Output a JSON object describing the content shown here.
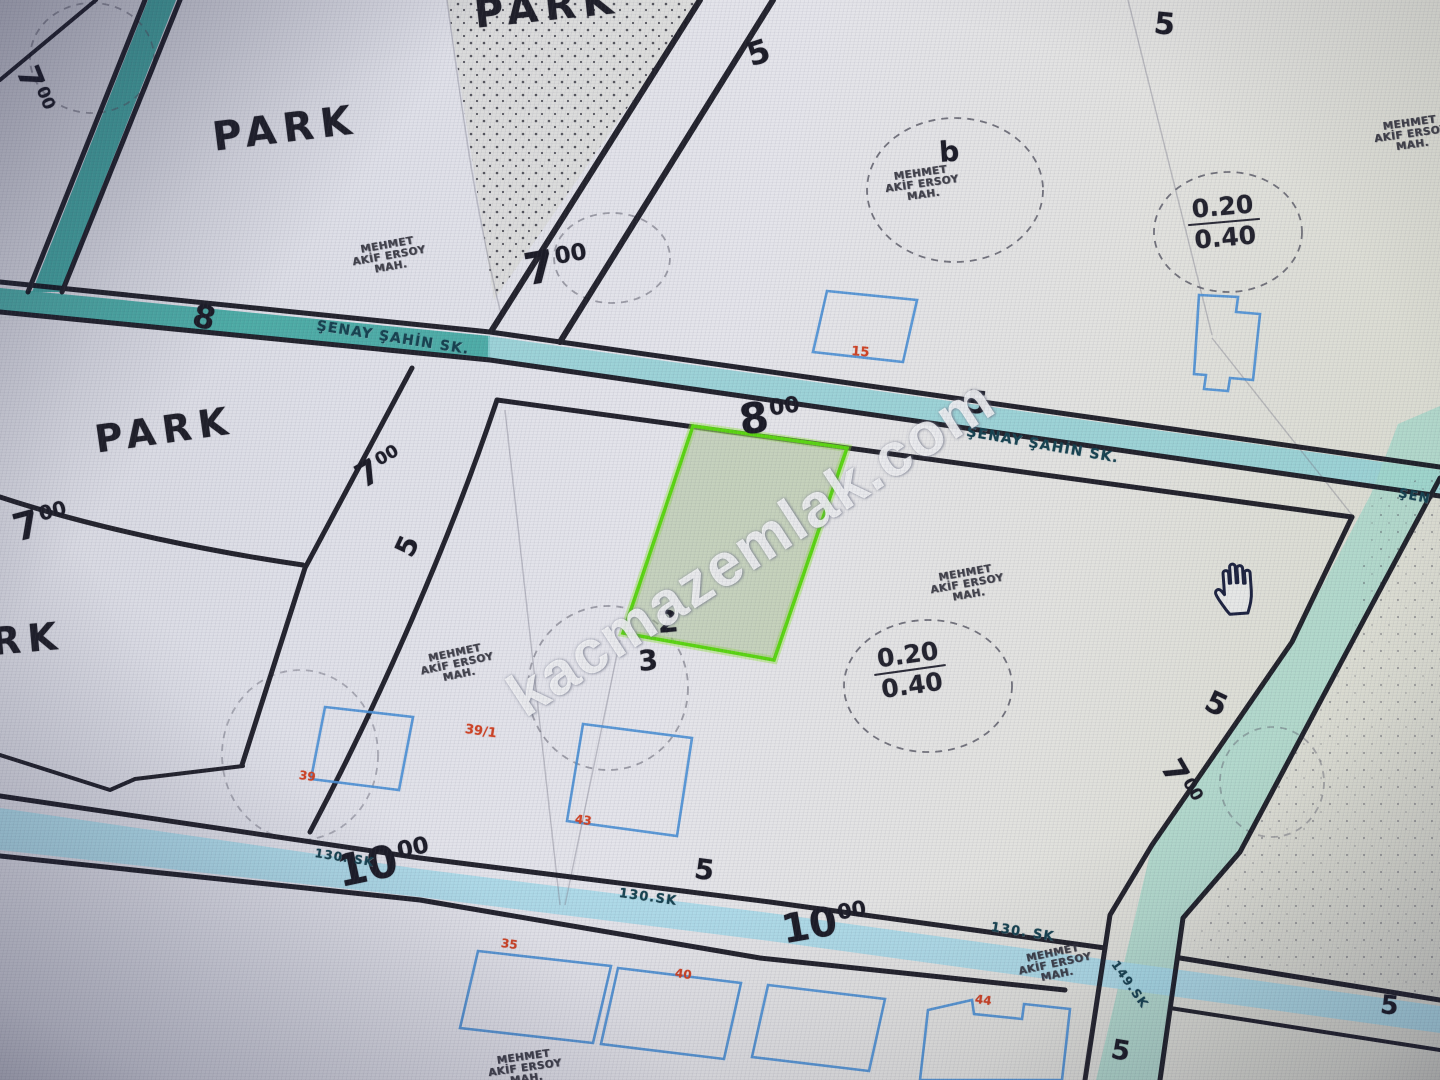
{
  "watermark": "kacmazemlak.com",
  "cursor": "open-hand",
  "stamp": {
    "l1": "MEHMET",
    "l2": "AKİF ERSOY",
    "l3": "MAH."
  },
  "parks": {
    "a": "PARK",
    "b": "PARK",
    "c": "PARK",
    "d": "PARK"
  },
  "streets": {
    "senay_left": "ŞENAY ŞAHİN SK.",
    "senay_right": "ŞENAY ŞAHİN SK.",
    "senay_clip": "ŞEN",
    "s130a": "130. SK",
    "s130b": "130.SK",
    "s130c": "130. SK",
    "s149": "149.SK"
  },
  "numbers": {
    "top7": {
      "b": "7",
      "s": "00"
    },
    "mid8": {
      "b": "8",
      "s": "00"
    },
    "l7a": {
      "b": "7",
      "s": "00"
    },
    "l7b": {
      "b": "7",
      "s": "00"
    },
    "tl7": {
      "b": "7",
      "s": "00"
    },
    "r7": {
      "b": "7",
      "s": "00"
    },
    "t10a": {
      "b": "10",
      "s": "00"
    },
    "t10b": {
      "b": "10",
      "s": "00"
    },
    "street8": "8",
    "five1": "5",
    "five2": "5",
    "five3": "5",
    "five4": "5",
    "five5": "5",
    "five6": "5",
    "five7": "5",
    "five8": "5",
    "lot2": "2",
    "lot3": "3",
    "lotb": "b"
  },
  "density": {
    "top": "0.20",
    "bottom": "0.40"
  },
  "red": {
    "n15": "15",
    "n39_1": "39/1",
    "n39": "39",
    "n43": "43",
    "n35": "35",
    "n40": "40",
    "n44": "44"
  },
  "colors": {
    "street_teal": "#3fa49e",
    "street_cyan_light": "#a5d8e8",
    "street_green_light": "#9fd6c8",
    "parcel_green": "#5bd512",
    "parcel_green_fill": "#9bb87f",
    "building_blue": "#4a8fd4",
    "red_label": "#cf4426",
    "line_black": "#15151f"
  }
}
